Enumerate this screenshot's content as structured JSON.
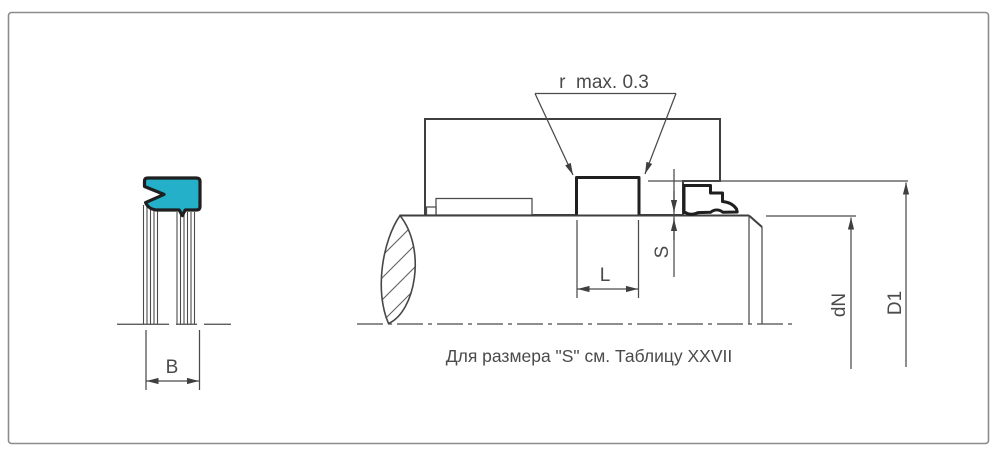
{
  "figure_title": "seal-installation-drawing",
  "colors": {
    "frame": "#8f8a8c",
    "line": "#3f3f3f",
    "thick": "#1f1f1f",
    "hatch": "#606060",
    "dim": "#4a4a4a",
    "seal_fill": "#24b0c9",
    "bg": "#ffffff"
  },
  "labels": {
    "radius_note": "r  max. 0.3",
    "groove_length": "L",
    "size_s": "S",
    "rod_diameter": "dN",
    "groove_diameter": "D1",
    "seal_width": "B",
    "footnote": "Для размера \"S\" см. Таблицу XXVII"
  }
}
